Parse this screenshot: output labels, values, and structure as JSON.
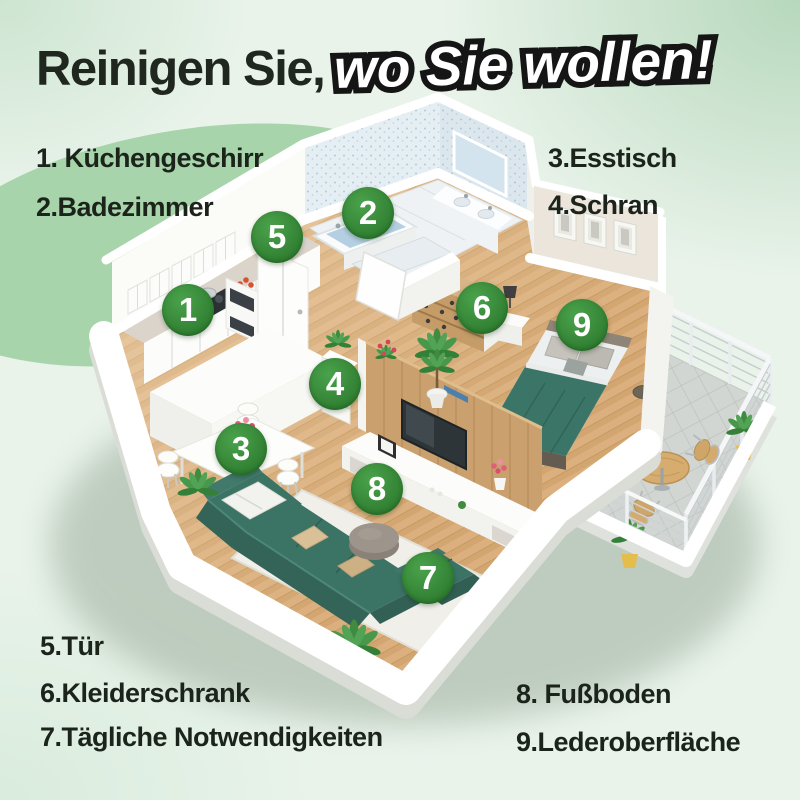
{
  "title": {
    "part1": "Reinigen Sie,",
    "part2": "wo Sie wollen!"
  },
  "legend": {
    "top_left": [
      {
        "text": "1. Küchengeschirr"
      },
      {
        "text": "2.Badezimmer"
      }
    ],
    "top_right": [
      {
        "text": "3.Esstisch"
      },
      {
        "text": "4.Schran"
      }
    ],
    "bottom_left": [
      {
        "text": "5.Tür"
      },
      {
        "text": "6.Kleiderschrank"
      },
      {
        "text": "7.Tägliche Notwendigkeiten"
      }
    ],
    "bottom_right": [
      {
        "text": "8. Fußboden"
      },
      {
        "text": "9.Lederoberfläche"
      }
    ]
  },
  "badges": [
    {
      "number": "1"
    },
    {
      "number": "2"
    },
    {
      "number": "3"
    },
    {
      "number": "4"
    },
    {
      "number": "5"
    },
    {
      "number": "6"
    },
    {
      "number": "7"
    },
    {
      "number": "8"
    },
    {
      "number": "9"
    }
  ],
  "colors": {
    "badge_green": "#38903a",
    "background_mint": "#e9f3ea",
    "accent_blob_green": "#a7d4aa",
    "title_dark": "#1f271f",
    "title_outline": "#151515",
    "sofa_teal": "#3b7365",
    "wood_floor": "#d9ad7a",
    "balcony_gray": "#d2d6d2",
    "bathroom_tile": "#e4eef3"
  }
}
